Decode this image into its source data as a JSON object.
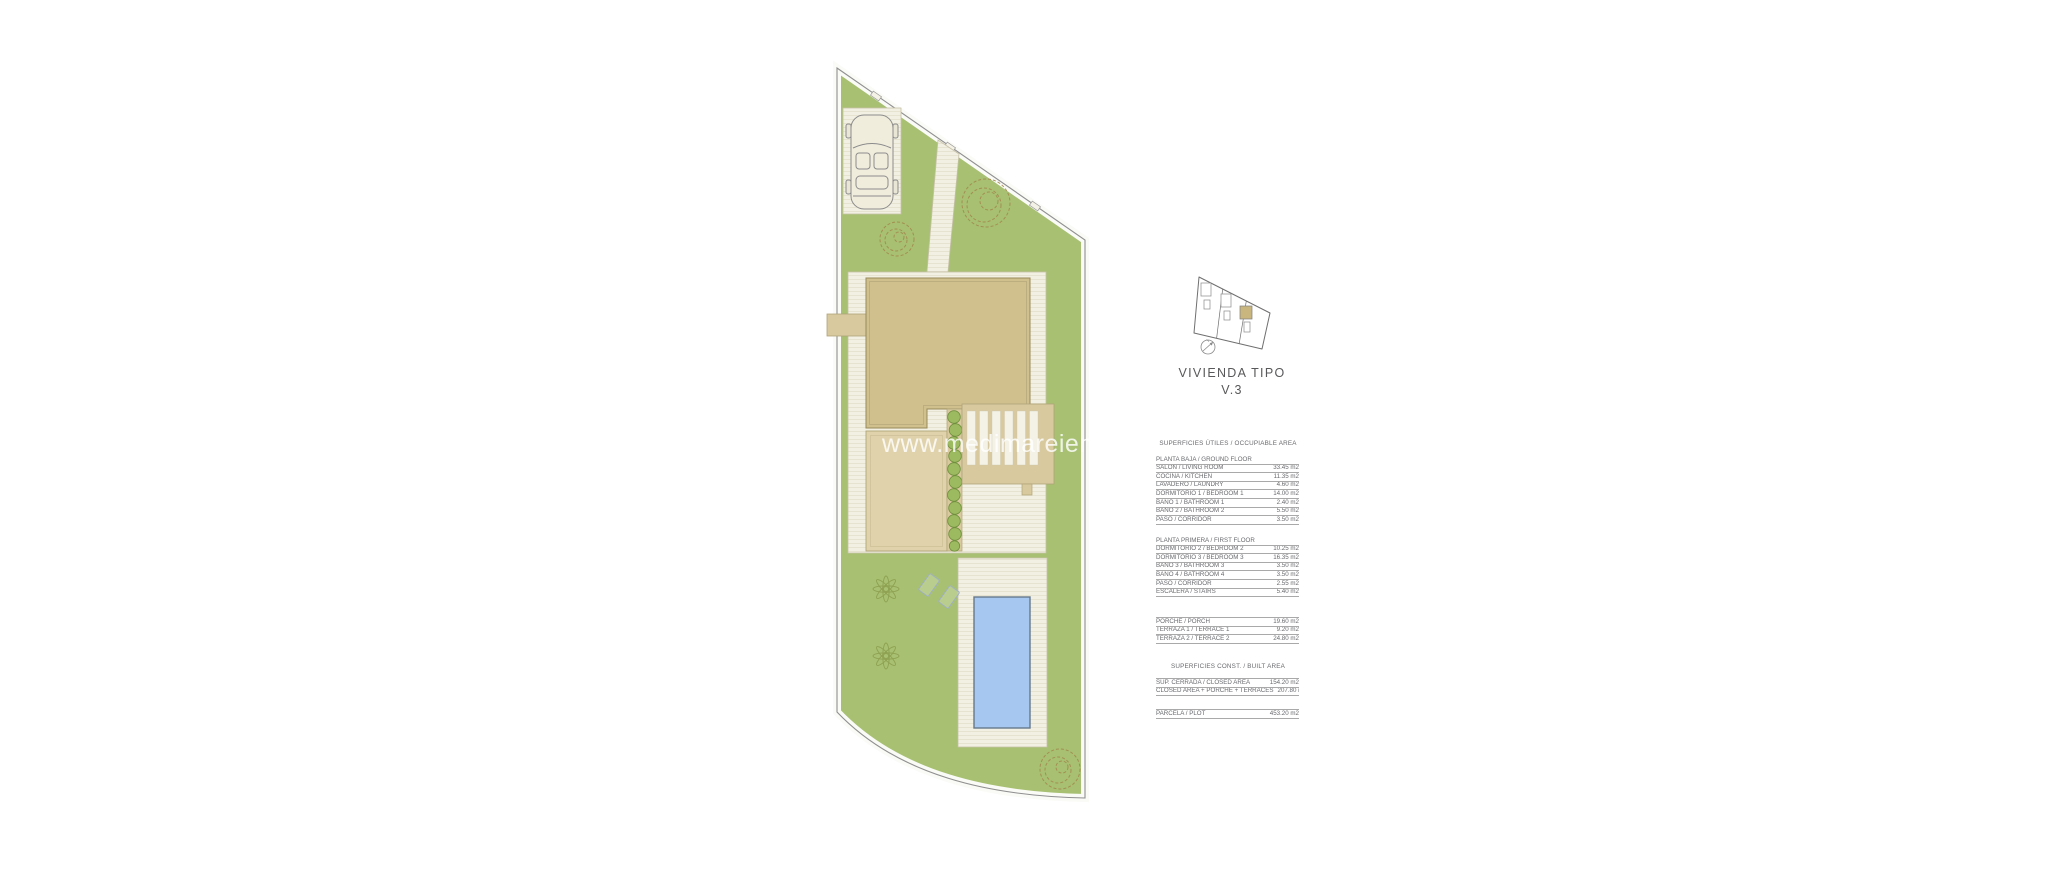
{
  "watermark": "www.medimareiendo",
  "title": {
    "line1": "VIVIENDA TIPO",
    "line2": "V.3"
  },
  "areas": {
    "occupiable_heading": "SUPERFICIES ÚTILES / OCCUPIABLE AREA",
    "ground_floor": {
      "header": "PLANTA BAJA / GROUND FLOOR",
      "rows": [
        [
          "SALÓN / LIVING ROOM",
          "33.45 m2"
        ],
        [
          "COCINA / KITCHEN",
          "11.35 m2"
        ],
        [
          "LAVADERO / LAUNDRY",
          "4.60 m2"
        ],
        [
          "DORMITORIO 1 /  BEDROOM 1",
          "14.00 m2"
        ],
        [
          "BAÑO 1 / BATHROOM 1",
          "2.40 m2"
        ],
        [
          "BAÑO 2 / BATHROOM 2",
          "5.50 m2"
        ],
        [
          "PASO / CORRIDOR",
          "3.50 m2"
        ]
      ]
    },
    "first_floor": {
      "header": "PLANTA PRIMERA / FIRST FLOOR",
      "rows": [
        [
          "DORMITORIO 2 / BEDROOM 2",
          "10.25 m2"
        ],
        [
          "DORMITORIO 3 / BEDROOM 3",
          "16.35 m2"
        ],
        [
          "BAÑO 3 / BATHROOM 3",
          "3.50 m2"
        ],
        [
          "BAÑO 4 / BATHROOM 4",
          "3.50 m2"
        ],
        [
          "PASO / CORRIDOR",
          "2.55 m2"
        ],
        [
          "ESCALERA / STAIRS",
          "5.40 m2"
        ]
      ]
    },
    "outdoor": {
      "rows": [
        [
          "PORCHE / PORCH",
          "19.60 m2"
        ],
        [
          "TERRAZA 1 / TERRACE 1",
          "9.20 m2"
        ],
        [
          "TERRAZA 2 / TERRACE 2",
          "24.80 m2"
        ]
      ]
    },
    "built_heading": "SUPERFICIES CONST. / BUILT AREA",
    "built": {
      "rows": [
        [
          "SUP. CERRADA / CLOSED AREA",
          "154.20 m2"
        ],
        [
          "CLOSED AREA + PORCHE + TERRACES",
          "207.80 m2"
        ]
      ]
    },
    "plot": {
      "rows": [
        [
          "PARCELA / PLOT",
          "453.20 m2"
        ]
      ]
    }
  },
  "colors": {
    "lawn": "#a7c071",
    "deck": "#f2f0e2",
    "roof_tan": "#cfc08e",
    "porch_tan": "#e0d3ac",
    "pergola_tan": "#d8c99f",
    "pool_blue": "#a6c7ef",
    "highlight_unit": "#c9b67f",
    "text_gray": "#696a6e"
  }
}
